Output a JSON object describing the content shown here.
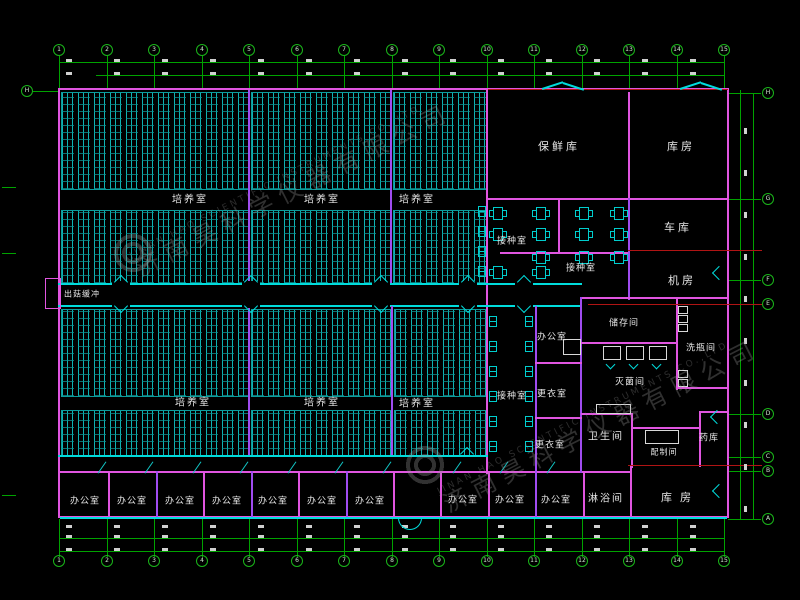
{
  "watermark": {
    "company_cn": "济南昊科学仪器有限公司",
    "company_en": "JINAN HAO SCIENTIFIC INSTRUMENTS CO.,LTD"
  },
  "grid": {
    "cols": [
      "1",
      "2",
      "3",
      "4",
      "5",
      "6",
      "7",
      "8",
      "9",
      "10",
      "11",
      "12",
      "13",
      "14",
      "15"
    ],
    "rows_right": [
      "H",
      "G",
      "F",
      "E",
      "D",
      "C",
      "B",
      "A"
    ],
    "rows_left": [
      "H"
    ]
  },
  "rooms": {
    "cultivation": [
      "培养室",
      "培养室",
      "培养室",
      "培养室",
      "培养室",
      "培养室"
    ],
    "offices": [
      "办公室",
      "办公室",
      "办公室",
      "办公室",
      "办公室",
      "办公室",
      "办公室",
      "办公室",
      "办公室",
      "办公室"
    ],
    "buffer_corridor": "出菇缓冲",
    "fresh_storage": "保鲜库",
    "storeroom_top": "库房",
    "garage": "车库",
    "machine_room": "机房",
    "inoculation": [
      "接种室",
      "接种室",
      "接种室"
    ],
    "office_small": "办公室",
    "changing": [
      "更衣室",
      "更衣室"
    ],
    "storage_room": "储存间",
    "bottle_washing": "洗瓶间",
    "sterilization": "灭菌间",
    "toilet": "卫生间",
    "preparation": "配制间",
    "medicine_store": "药库",
    "shower": "淋浴间",
    "storeroom_bottom": "库房"
  }
}
